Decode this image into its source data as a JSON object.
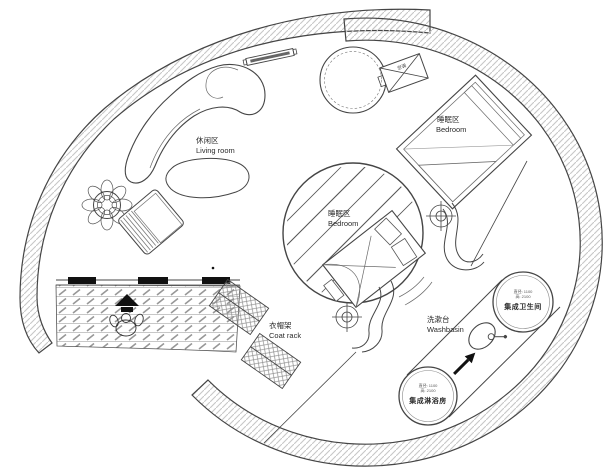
{
  "plan_type": "circular-house-floor-plan",
  "colors": {
    "background": "#ffffff",
    "wall_line": "#454545",
    "wall_hatch": "#c7c7c7",
    "paving_hatch": "#9a9a9a",
    "text": "#2b2b2b",
    "solid_black": "#111111"
  },
  "labels": {
    "living": {
      "zh": "休闲区",
      "en": "Living room"
    },
    "bedroom_right": {
      "zh": "睡眠区",
      "en": "Bedroom"
    },
    "bedroom_center": {
      "zh": "睡眠区",
      "en": "Bedroom"
    },
    "coat_rack": {
      "zh": "衣帽架",
      "en": "Coat rack"
    },
    "washbasin": {
      "zh": "洗漱台",
      "en": "Washbasin"
    },
    "toilet_pod": {
      "name": "集成卫生间",
      "spec1": "直径: 1100",
      "spec2": "高: 2100"
    },
    "shower_pod": {
      "name": "集成淋浴房",
      "spec1": "直径: 1100",
      "spec2": "高: 2100"
    },
    "ac_unit": {
      "zh": "空调"
    }
  },
  "symbols": {
    "entry-arrow-icon": "solid up arrow",
    "person-icon": "top-view walking figure",
    "column-marker-icon": "crosshair target",
    "plant-icon": "potted plant",
    "sink-icon": "oval basin with faucet",
    "ac-unit-icon": "crossed rectangle",
    "flow-arrow-icon": "black diagonal arrow"
  }
}
